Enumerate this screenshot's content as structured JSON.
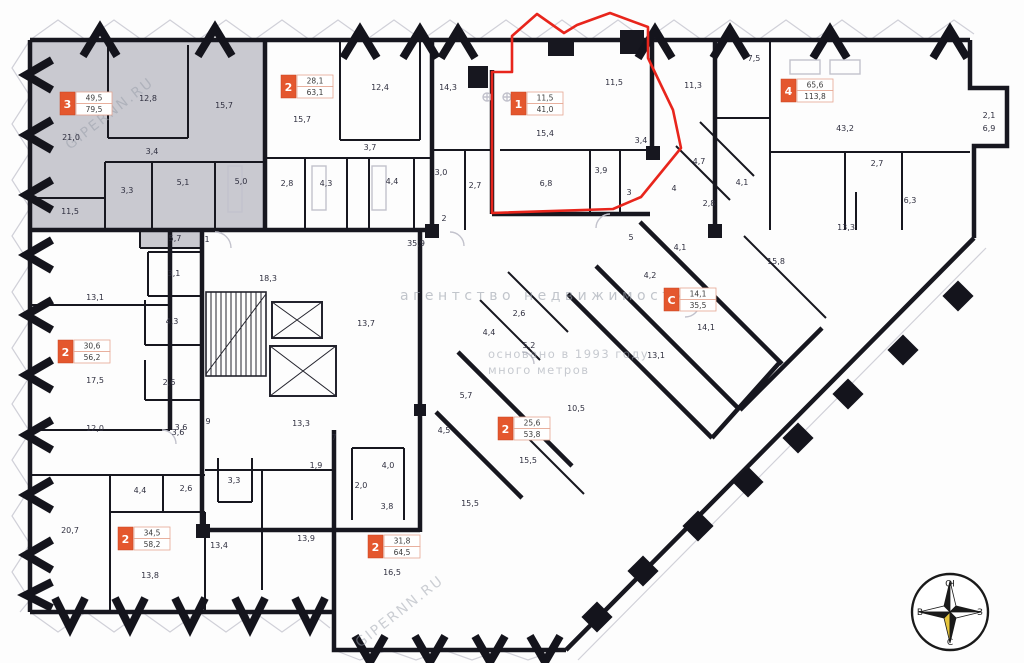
{
  "watermarks": {
    "site": "GIPERNN.RU",
    "agency": "агентство  недвижимости ®",
    "founded": "основано в 1993 году",
    "brand": "много метров"
  },
  "compass": {
    "top": "Ю",
    "right": "З",
    "bottom": "С",
    "left": "В"
  },
  "units": [
    {
      "rooms": "3",
      "living": "49,5",
      "total": "79,5"
    },
    {
      "rooms": "2",
      "living": "28,1",
      "total": "63,1"
    },
    {
      "rooms": "1",
      "living": "11,5",
      "total": "41,0"
    },
    {
      "rooms": "4",
      "living": "65,6",
      "total": "113,8"
    },
    {
      "rooms": "С",
      "living": "14,1",
      "total": "35,5"
    },
    {
      "rooms": "2",
      "living": "30,6",
      "total": "56,2"
    },
    {
      "rooms": "2",
      "living": "34,5",
      "total": "58,2"
    },
    {
      "rooms": "2",
      "living": "31,8",
      "total": "64,5"
    },
    {
      "rooms": "2",
      "living": "25,6",
      "total": "53,8"
    }
  ],
  "rooms": [
    "21,0",
    "12,8",
    "15,7",
    "3,4",
    "3,3",
    "5,1",
    "5,0",
    "11,5",
    "5,7",
    "1",
    "15,7",
    "12,4",
    "3,7",
    "2,8",
    "4,3",
    "4,4",
    "14,3",
    "3,0",
    "2,7",
    "2",
    "15,4",
    "11,5",
    "3,4",
    "3,9",
    "3",
    "6,8",
    "11,3",
    "7,5",
    "43,2",
    "2,1",
    "6,9",
    "4,7",
    "4,1",
    "2,8",
    "2,7",
    "6,3",
    "13,3",
    "15,8",
    "4,1",
    "4,2",
    "14,1",
    "13,1",
    "4",
    "5",
    "35,9",
    "18,3",
    "3,1",
    "4,3",
    "2,6",
    "13,7",
    "13,3",
    "9",
    "3,6",
    "2,6",
    "4,4",
    "5,2",
    "13,1",
    "17,5",
    "12,0",
    "3,6",
    "4,4",
    "2,6",
    "20,7",
    "13,8",
    "13,4",
    "13,9",
    "3,3",
    "1,9",
    "7",
    "4,0",
    "2,0",
    "3,8",
    "4,5",
    "15,5",
    "15,5",
    "10,5",
    "16,5",
    "5,7"
  ],
  "colors": {
    "wall": "#17171f",
    "selected": "#e8251c",
    "unit_badge": "#e4572e",
    "gray_unit": "#c6c6cd",
    "compass_gold": "#e6c53c"
  }
}
